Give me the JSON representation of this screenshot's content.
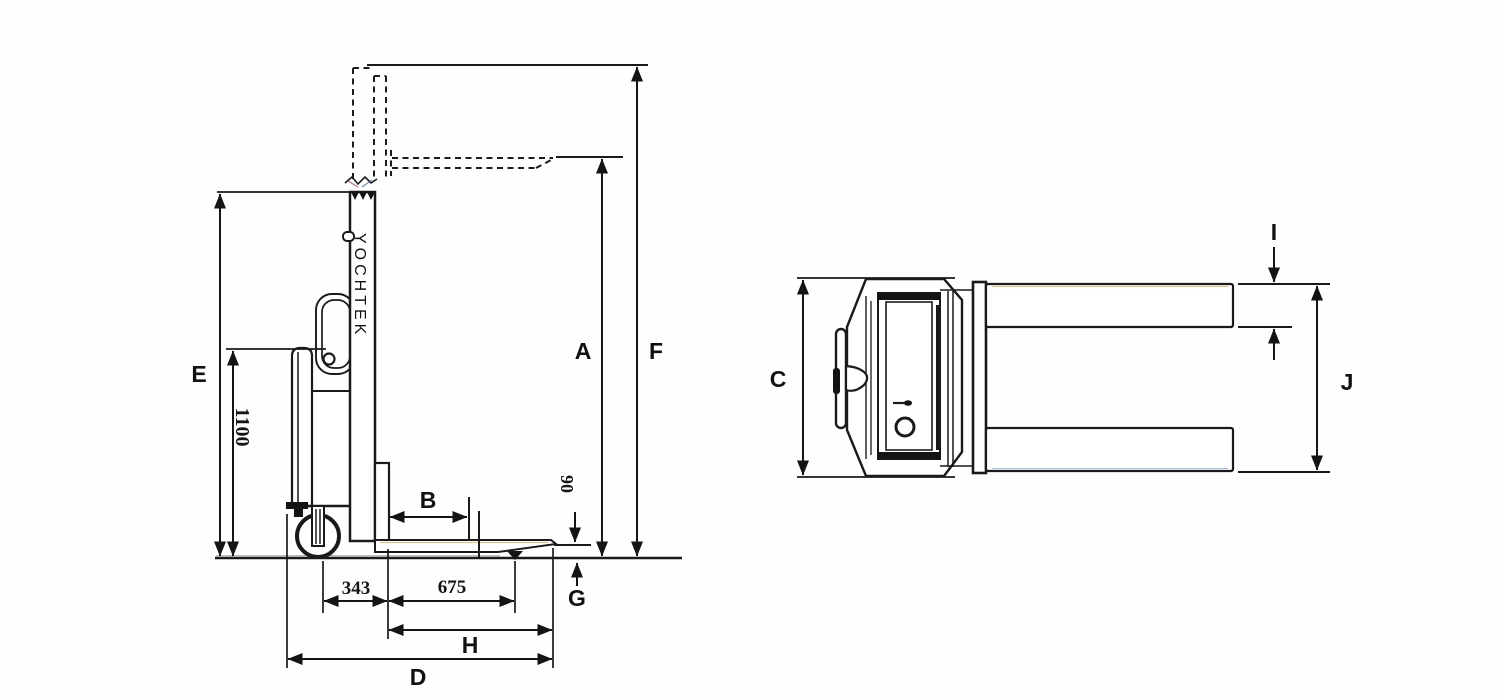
{
  "drawing": {
    "title": "pallet-stacker-dimensional-drawing",
    "brand_text": "YOCHTEK",
    "ink_color": "#1a1a1a",
    "background_color": "#fefefe",
    "side_view": {
      "labels": {
        "A": "A",
        "B": "B",
        "D": "D",
        "E": "E",
        "F": "F",
        "G": "G",
        "H": "H"
      },
      "values": {
        "tiller_height": "1100",
        "caster_to_fork": "343",
        "fork_support_length": "675",
        "fork_lowered_height": "90"
      }
    },
    "top_view": {
      "labels": {
        "C": "C",
        "I": "I",
        "J": "J"
      }
    }
  }
}
